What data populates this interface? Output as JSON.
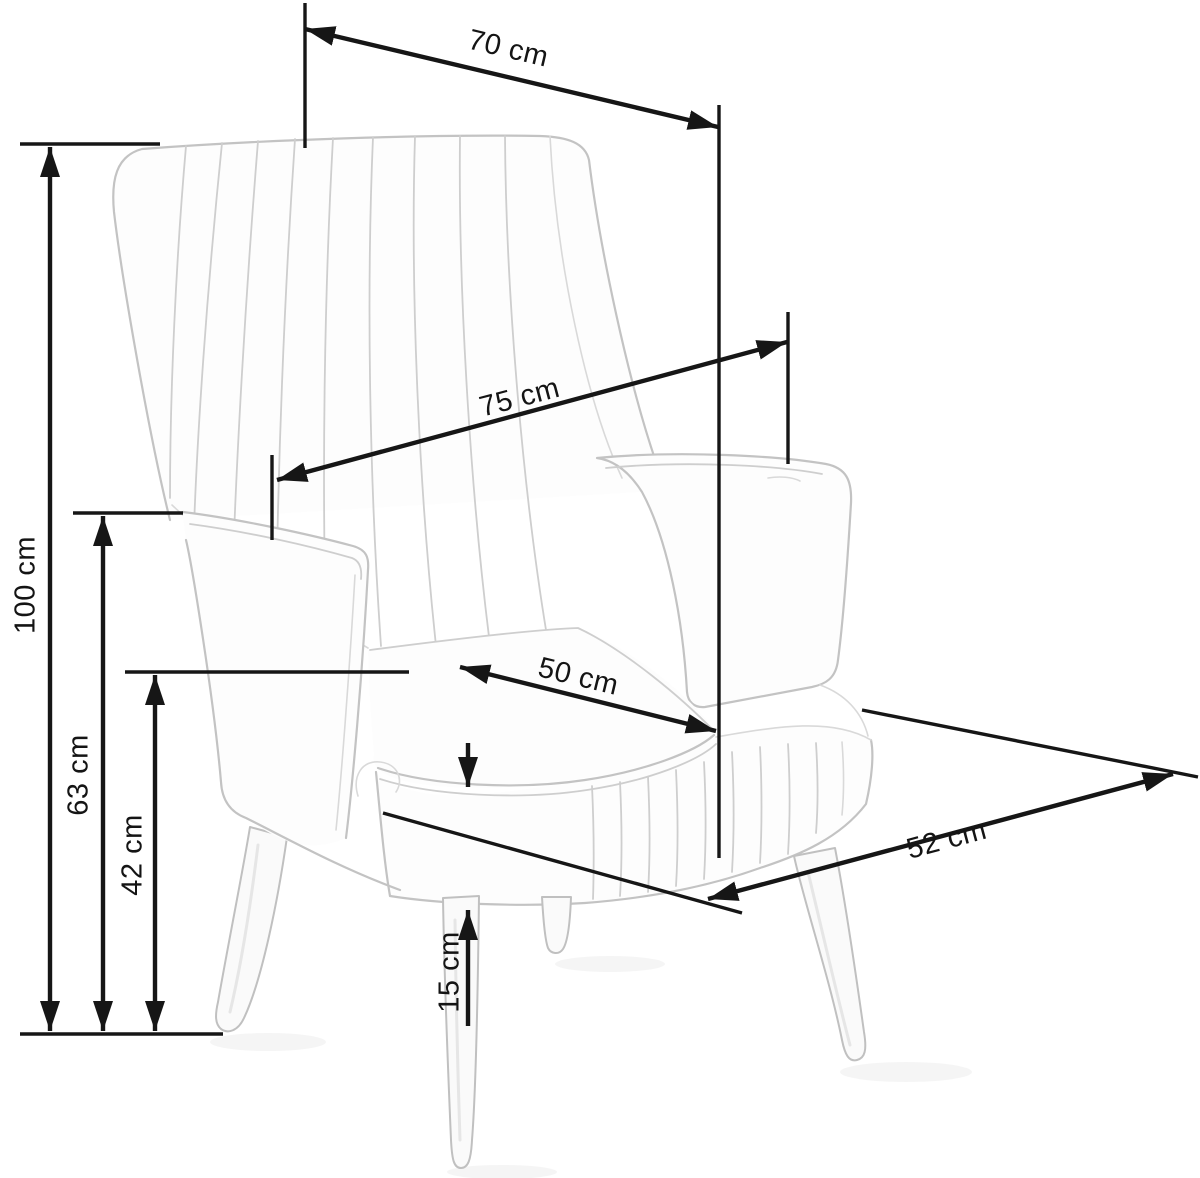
{
  "title": "Armchair dimensions diagram",
  "unit": "cm",
  "colors": {
    "background": "#ffffff",
    "dimension_lines": "#161616",
    "sketch_lines": "#c3c3c3"
  },
  "dimensions": {
    "width_top": {
      "label": "70 cm",
      "value": 70
    },
    "depth_overall": {
      "label": "75 cm",
      "value": 75
    },
    "height_overall": {
      "label": "100 cm",
      "value": 100
    },
    "height_armrest": {
      "label": "63 cm",
      "value": 63
    },
    "height_seat": {
      "label": "42 cm",
      "value": 42
    },
    "cushion_thickness": {
      "label": "15 cm",
      "value": 15
    },
    "seat_width": {
      "label": "50 cm",
      "value": 50
    },
    "seat_depth": {
      "label": "52 cm",
      "value": 52
    }
  }
}
